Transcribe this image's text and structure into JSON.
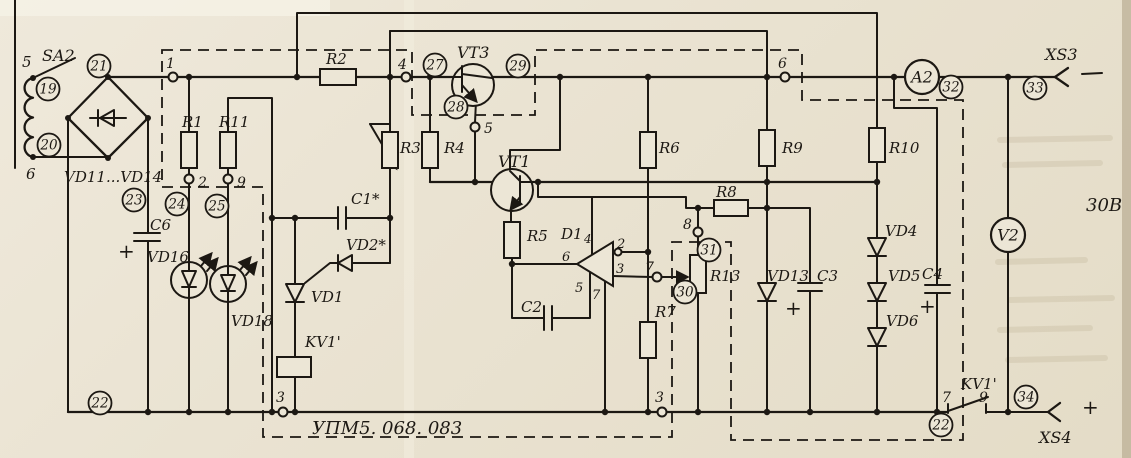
{
  "schematic": {
    "module_code": "УПМ5. 068. 083",
    "output_voltage": "30В",
    "paper_color": "#ece6d6",
    "ink_color": "#1c1813",
    "component_labels": [
      {
        "id": "switch-sa2",
        "text": "SA2",
        "x": 42,
        "y": 61,
        "s": 16
      },
      {
        "id": "coil-terminal-5",
        "text": "5",
        "x": 22,
        "y": 67,
        "s": 15
      },
      {
        "id": "coil-terminal-6",
        "text": "6",
        "x": 26,
        "y": 179,
        "s": 15
      },
      {
        "id": "bridge-vd11-vd14",
        "text": "VD11...VD14",
        "x": 64,
        "y": 182,
        "s": 15
      },
      {
        "id": "resistor-r1",
        "text": "R1",
        "x": 182,
        "y": 127,
        "s": 15
      },
      {
        "id": "resistor-r11",
        "text": "R11",
        "x": 219,
        "y": 127,
        "s": 15
      },
      {
        "id": "capacitor-c6",
        "text": "C6",
        "x": 150,
        "y": 230,
        "s": 15
      },
      {
        "id": "led-vd16",
        "text": "VD16",
        "x": 147,
        "y": 262,
        "s": 15
      },
      {
        "id": "led-vd18",
        "text": "VD18",
        "x": 231,
        "y": 326,
        "s": 15
      },
      {
        "id": "resistor-r2",
        "text": "R2",
        "x": 326,
        "y": 64,
        "s": 15
      },
      {
        "id": "resistor-r3",
        "text": "R3",
        "x": 400,
        "y": 153,
        "s": 15
      },
      {
        "id": "resistor-r4",
        "text": "R4",
        "x": 444,
        "y": 153,
        "s": 15
      },
      {
        "id": "resistor-r5",
        "text": "R5",
        "x": 527,
        "y": 241,
        "s": 15
      },
      {
        "id": "transistor-vt3",
        "text": "VT3",
        "x": 457,
        "y": 58,
        "s": 16
      },
      {
        "id": "transistor-vt1",
        "text": "VT1",
        "x": 498,
        "y": 167,
        "s": 16
      },
      {
        "id": "opamp-d1",
        "text": "D1",
        "x": 561,
        "y": 239,
        "s": 15
      },
      {
        "id": "capacitor-c1",
        "text": "C1*",
        "x": 351,
        "y": 204,
        "s": 15
      },
      {
        "id": "diode-vd2",
        "text": "VD2*",
        "x": 346,
        "y": 250,
        "s": 15
      },
      {
        "id": "thyristor-vd1",
        "text": "VD1",
        "x": 311,
        "y": 302,
        "s": 15
      },
      {
        "id": "relay-coil-kv1",
        "text": "KV1'",
        "x": 305,
        "y": 347,
        "s": 15
      },
      {
        "id": "capacitor-c2",
        "text": "C2",
        "x": 521,
        "y": 312,
        "s": 15
      },
      {
        "id": "resistor-r6",
        "text": "R6",
        "x": 659,
        "y": 153,
        "s": 15
      },
      {
        "id": "resistor-r7",
        "text": "R7",
        "x": 655,
        "y": 317,
        "s": 15
      },
      {
        "id": "resistor-r8",
        "text": "R8",
        "x": 716,
        "y": 197,
        "s": 15
      },
      {
        "id": "resistor-r9",
        "text": "R9",
        "x": 782,
        "y": 153,
        "s": 15
      },
      {
        "id": "resistor-r10",
        "text": "R10",
        "x": 889,
        "y": 153,
        "s": 15
      },
      {
        "id": "resistor-r13",
        "text": "R13",
        "x": 710,
        "y": 281,
        "s": 15
      },
      {
        "id": "diode-vd13",
        "text": "VD13",
        "x": 767,
        "y": 281,
        "s": 15
      },
      {
        "id": "capacitor-c3",
        "text": "C3",
        "x": 817,
        "y": 281,
        "s": 15
      },
      {
        "id": "diode-vd4",
        "text": "VD4",
        "x": 885,
        "y": 236,
        "s": 15
      },
      {
        "id": "diode-vd5",
        "text": "VD5",
        "x": 888,
        "y": 281,
        "s": 15
      },
      {
        "id": "diode-vd6",
        "text": "VD6",
        "x": 886,
        "y": 326,
        "s": 15
      },
      {
        "id": "capacitor-c4",
        "text": "C4",
        "x": 922,
        "y": 279,
        "s": 15
      },
      {
        "id": "relay-contact-kv1",
        "text": "KV1'",
        "x": 961,
        "y": 389,
        "s": 15
      },
      {
        "id": "connector-xs3",
        "text": "XS3",
        "x": 1045,
        "y": 60,
        "s": 16
      },
      {
        "id": "connector-xs4",
        "text": "XS4",
        "x": 1039,
        "y": 443,
        "s": 16
      },
      {
        "id": "d1-pin-4",
        "text": "4",
        "x": 584,
        "y": 243,
        "s": 12
      },
      {
        "id": "d1-pin-2",
        "text": "2",
        "x": 617,
        "y": 248,
        "s": 13
      },
      {
        "id": "d1-pin-3",
        "text": "3",
        "x": 616,
        "y": 273,
        "s": 13
      },
      {
        "id": "d1-pin-6",
        "text": "6",
        "x": 562,
        "y": 261,
        "s": 13
      },
      {
        "id": "d1-pin-5",
        "text": "5",
        "x": 575,
        "y": 292,
        "s": 13
      },
      {
        "id": "d1-pin-7",
        "text": "7",
        "x": 592,
        "y": 299,
        "s": 13
      },
      {
        "id": "kv1-contact-pin-7",
        "text": "7",
        "x": 942,
        "y": 402,
        "s": 14
      },
      {
        "id": "kv1-contact-pin-9",
        "text": "9",
        "x": 979,
        "y": 402,
        "s": 14
      }
    ],
    "plus_marks": [
      {
        "id": "c6-plus",
        "x": 118,
        "y": 258
      },
      {
        "id": "c3-plus",
        "x": 785,
        "y": 315
      },
      {
        "id": "c4-plus",
        "x": 919,
        "y": 313
      },
      {
        "id": "xs4-plus",
        "x": 1082,
        "y": 414
      }
    ],
    "pins": [
      {
        "n": "1",
        "cx": 173,
        "cy": 77,
        "lx": 166,
        "ly": 68
      },
      {
        "n": "2",
        "cx": 189,
        "cy": 179,
        "lx": 198,
        "ly": 187
      },
      {
        "n": "9",
        "cx": 228,
        "cy": 179,
        "lx": 237,
        "ly": 187
      },
      {
        "n": "4",
        "cx": 406,
        "cy": 77,
        "lx": 398,
        "ly": 69
      },
      {
        "n": "5",
        "cx": 475,
        "cy": 127,
        "lx": 484,
        "ly": 133
      },
      {
        "n": "6",
        "cx": 785,
        "cy": 77,
        "lx": 778,
        "ly": 68
      },
      {
        "n": "7",
        "cx": 657,
        "cy": 277,
        "lx": 645,
        "ly": 272
      },
      {
        "n": "8",
        "cx": 698,
        "cy": 232,
        "lx": 683,
        "ly": 229
      },
      {
        "n": "3",
        "cx": 283,
        "cy": 412,
        "lx": 276,
        "ly": 402
      },
      {
        "n": "3",
        "cx": 662,
        "cy": 412,
        "lx": 655,
        "ly": 402
      }
    ],
    "wire_numbers": [
      {
        "n": "19",
        "cx": 48,
        "cy": 89
      },
      {
        "n": "20",
        "cx": 49,
        "cy": 145
      },
      {
        "n": "21",
        "cx": 99,
        "cy": 66
      },
      {
        "n": "22",
        "cx": 100,
        "cy": 403
      },
      {
        "n": "22",
        "cx": 941,
        "cy": 425
      },
      {
        "n": "23",
        "cx": 134,
        "cy": 200
      },
      {
        "n": "24",
        "cx": 177,
        "cy": 204
      },
      {
        "n": "25",
        "cx": 217,
        "cy": 206
      },
      {
        "n": "27",
        "cx": 435,
        "cy": 65
      },
      {
        "n": "28",
        "cx": 456,
        "cy": 107
      },
      {
        "n": "29",
        "cx": 518,
        "cy": 66
      },
      {
        "n": "30",
        "cx": 685,
        "cy": 292
      },
      {
        "n": "31",
        "cx": 709,
        "cy": 250
      },
      {
        "n": "32",
        "cx": 951,
        "cy": 87
      },
      {
        "n": "33",
        "cx": 1035,
        "cy": 88
      },
      {
        "n": "34",
        "cx": 1026,
        "cy": 397
      }
    ],
    "meters": [
      {
        "label": "A2",
        "cx": 922,
        "cy": 77
      },
      {
        "label": "V2",
        "cx": 1008,
        "cy": 235
      }
    ]
  }
}
